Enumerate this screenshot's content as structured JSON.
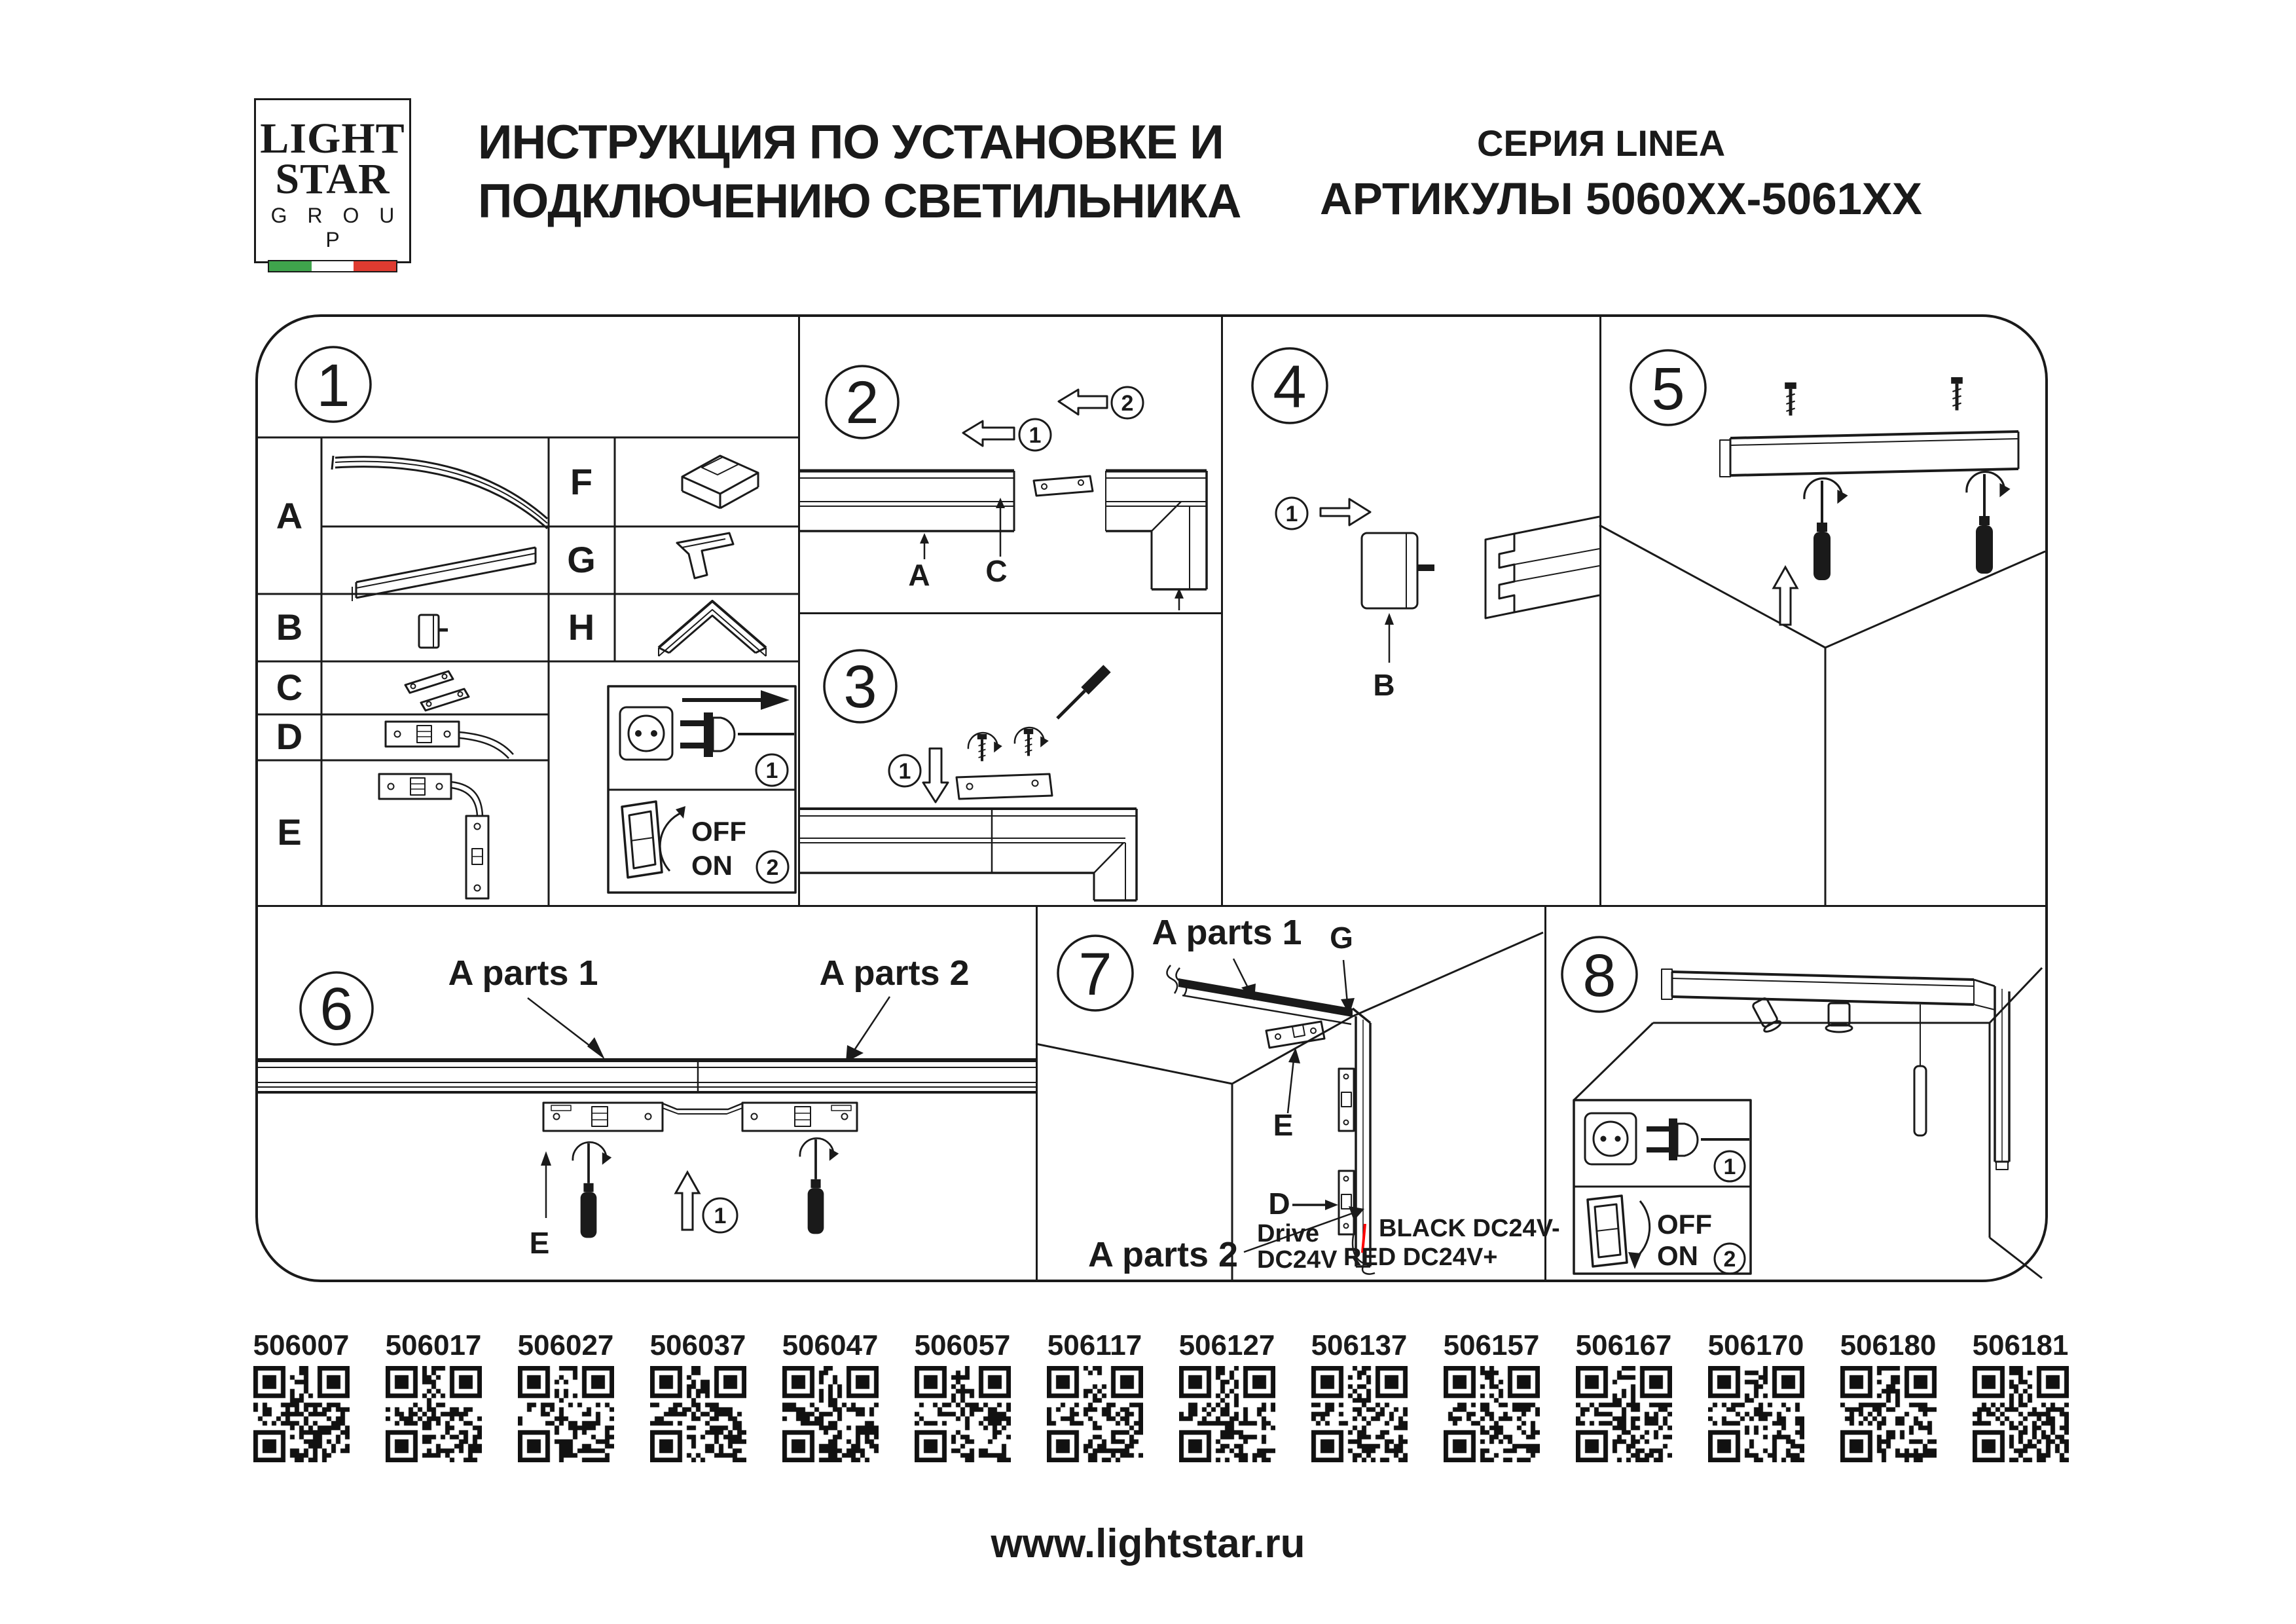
{
  "header": {
    "logo": {
      "word1": "LIGHT",
      "word2": "STAR",
      "word3": "G R O U P"
    },
    "title_line1": "ИНСТРУКЦИЯ ПО УСТАНОВКЕ И",
    "title_line2": "ПОДКЛЮЧЕНИЮ СВЕТИЛЬНИКА",
    "series": "СЕРИЯ LINEA",
    "articles": "АРТИКУЛЫ 5060XX-5061XX"
  },
  "colors": {
    "line": "#1a1a1a",
    "flag_green": "#3fa44c",
    "flag_white": "#ffffff",
    "flag_red": "#de3b30",
    "wire_red": "#ff0000"
  },
  "icons": [
    "outlet-icon",
    "plug-icon",
    "rocker-switch-icon",
    "screwdriver-icon",
    "screw-icon",
    "arrow-icon",
    "qr-code"
  ],
  "panel1": {
    "num": "1",
    "parts": {
      "a": "A",
      "b": "B",
      "c": "C",
      "d": "D",
      "e": "E",
      "f": "F",
      "g": "G",
      "h": "H"
    },
    "power": {
      "step1": "1",
      "step2": "2",
      "off": "OFF",
      "on": "ON"
    }
  },
  "panel2": {
    "num": "2",
    "step1": "1",
    "step2": "2",
    "label_a": "A",
    "label_c": "C"
  },
  "panel3": {
    "num": "3",
    "step1": "1"
  },
  "panel4": {
    "num": "4",
    "step1": "1",
    "label_b": "B"
  },
  "panel5": {
    "num": "5"
  },
  "panel6": {
    "num": "6",
    "a_parts1": "A parts 1",
    "a_parts2": "A parts 2",
    "label_e": "E",
    "step1": "1"
  },
  "panel7": {
    "num": "7",
    "a_parts1": "A parts 1",
    "a_parts2": "A parts 2",
    "label_g": "G",
    "label_e": "E",
    "label_d": "D",
    "drive1": "Drive",
    "drive2": "DC24V",
    "wire_black": "BLACK DC24V-",
    "wire_red": "RED DC24V+"
  },
  "panel8": {
    "num": "8",
    "step1": "1",
    "step2": "2",
    "off": "OFF",
    "on": "ON"
  },
  "qr": {
    "items": [
      {
        "article": "506007"
      },
      {
        "article": "506017"
      },
      {
        "article": "506027"
      },
      {
        "article": "506037"
      },
      {
        "article": "506047"
      },
      {
        "article": "506057"
      },
      {
        "article": "506117"
      },
      {
        "article": "506127"
      },
      {
        "article": "506137"
      },
      {
        "article": "506157"
      },
      {
        "article": "506167"
      },
      {
        "article": "506170"
      },
      {
        "article": "506180"
      },
      {
        "article": "506181"
      }
    ]
  },
  "footer": {
    "url": "www.lightstar.ru"
  }
}
